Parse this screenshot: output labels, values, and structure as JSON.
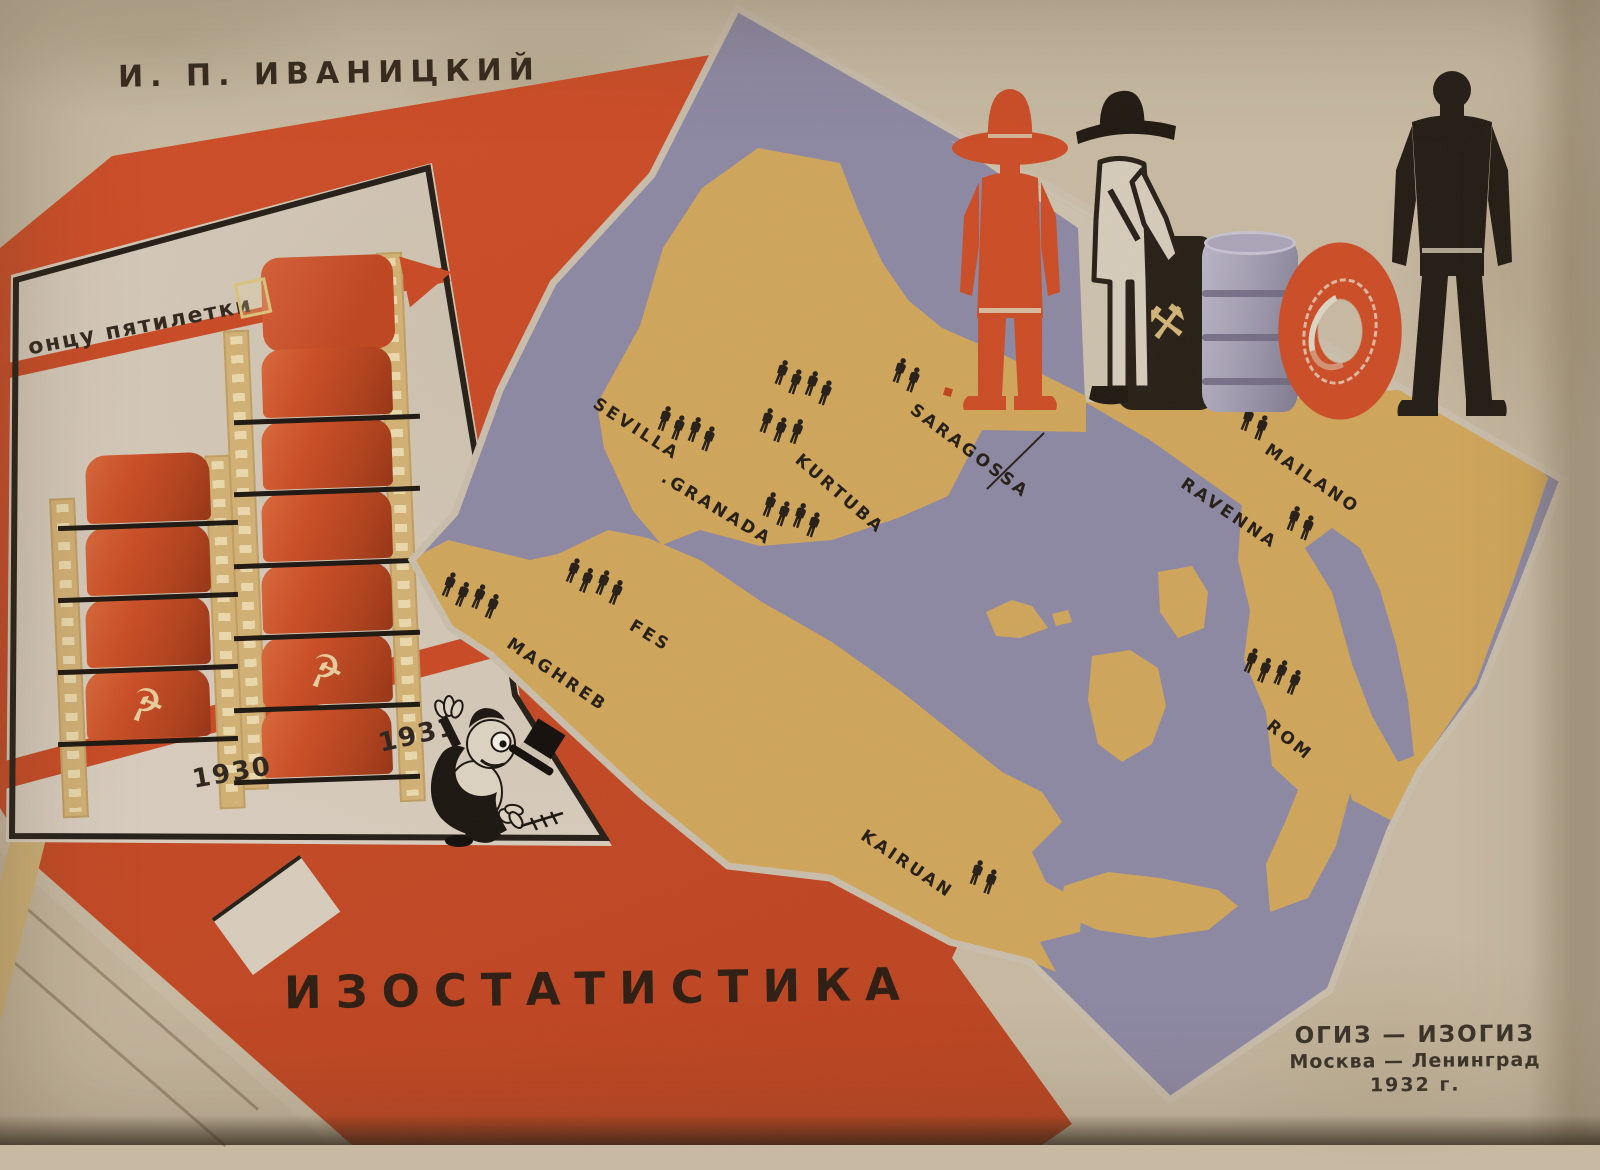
{
  "canvas": {
    "width": 1600,
    "height": 1145
  },
  "cover": {
    "author": "И. П. ИВАНИЦКИЙ",
    "title": "ИЗОСТАТИСТИКА",
    "publisher_line1": "ОГИЗ — ИЗОГИЗ",
    "publisher_line2": "Москва — Ленинград",
    "publisher_line3": "1932 г."
  },
  "inset_chart": {
    "slogan": "онцу пятилетки",
    "chart_data": {
      "type": "bar",
      "pictogram": "red-oil-barrel",
      "categories": [
        "1930",
        "1931"
      ],
      "values": [
        4,
        6
      ],
      "annotations": [
        "онцу пятилетки"
      ],
      "emblem_icon": "hammer-and-sickle"
    }
  },
  "glyphs": {
    "hammer_sickle": "☭",
    "crossed_hammers": "⚒"
  },
  "map": {
    "colors": {
      "sea": "#8e89a4",
      "land": "#d0a65b",
      "sheet": "#cbbfae"
    },
    "markers": [
      {
        "id": "sevilla",
        "label": "SEVILLA",
        "people": 4,
        "label_x": 600,
        "label_y": 394,
        "label_rot": 33,
        "rows": [
          {
            "count": 4,
            "x": 663,
            "y": 404,
            "rot": 20
          }
        ]
      },
      {
        "id": "kurtuba",
        "label": "KURTUBA",
        "people": 7,
        "label_x": 804,
        "label_y": 450,
        "label_rot": 41,
        "rows": [
          {
            "count": 4,
            "x": 780,
            "y": 358,
            "rot": 20
          },
          {
            "count": 3,
            "x": 765,
            "y": 406,
            "rot": 20
          }
        ]
      },
      {
        "id": "granada",
        "label": ".GRANADA",
        "people": 4,
        "label_x": 668,
        "label_y": 468,
        "label_rot": 31,
        "rows": [
          {
            "count": 4,
            "x": 768,
            "y": 490,
            "rot": 20
          }
        ]
      },
      {
        "id": "saragossa",
        "label": "SARAGOSSA",
        "people": 2,
        "label_x": 918,
        "label_y": 400,
        "label_rot": 37,
        "rows": [
          {
            "count": 2,
            "x": 898,
            "y": 356,
            "rot": 20
          }
        ],
        "dot": {
          "x": 944,
          "y": 388
        },
        "leader": {
          "x1": 987,
          "y1": 488,
          "x2": 1044,
          "y2": 432
        }
      },
      {
        "id": "mailano",
        "label": "MAILANO",
        "people": 2,
        "label_x": 1272,
        "label_y": 440,
        "label_rot": 34,
        "rows": [
          {
            "count": 2,
            "x": 1246,
            "y": 404,
            "rot": 20
          }
        ]
      },
      {
        "id": "ravenna",
        "label": "RAVENNA",
        "people": 2,
        "label_x": 1188,
        "label_y": 474,
        "label_rot": 34,
        "rows": [
          {
            "count": 2,
            "x": 1292,
            "y": 504,
            "rot": 20
          }
        ]
      },
      {
        "id": "rom",
        "label": "ROM",
        "people": 4,
        "label_x": 1275,
        "label_y": 716,
        "label_rot": 39,
        "rows": [
          {
            "count": 4,
            "x": 1250,
            "y": 646,
            "rot": 22
          }
        ]
      },
      {
        "id": "fes",
        "label": "FES",
        "people": 4,
        "label_x": 636,
        "label_y": 616,
        "label_rot": 31,
        "rows": [
          {
            "count": 4,
            "x": 572,
            "y": 556,
            "rot": 22
          }
        ]
      },
      {
        "id": "maghreb",
        "label": "MAGHREB",
        "people": 4,
        "label_x": 514,
        "label_y": 634,
        "label_rot": 34,
        "rows": [
          {
            "count": 4,
            "x": 448,
            "y": 570,
            "rot": 22
          }
        ]
      },
      {
        "id": "kairuan",
        "label": "KAIRUAN",
        "people": 2,
        "label_x": 868,
        "label_y": 826,
        "label_rot": 34,
        "rows": [
          {
            "count": 2,
            "x": 975,
            "y": 858,
            "rot": 20
          }
        ]
      }
    ]
  },
  "figures": [
    {
      "name": "red-peasant-figure"
    },
    {
      "name": "white-miner-figure"
    },
    {
      "name": "coal-barrel-with-crossed-hammers"
    },
    {
      "name": "steel-barrel"
    },
    {
      "name": "tire"
    },
    {
      "name": "black-worker-figure"
    },
    {
      "name": "falling-capitalist-cartoon"
    }
  ],
  "colors": {
    "paper": "#c7b9a2",
    "red": "#c64a26",
    "panel": "#d9cec0",
    "ink": "#2c231a"
  }
}
